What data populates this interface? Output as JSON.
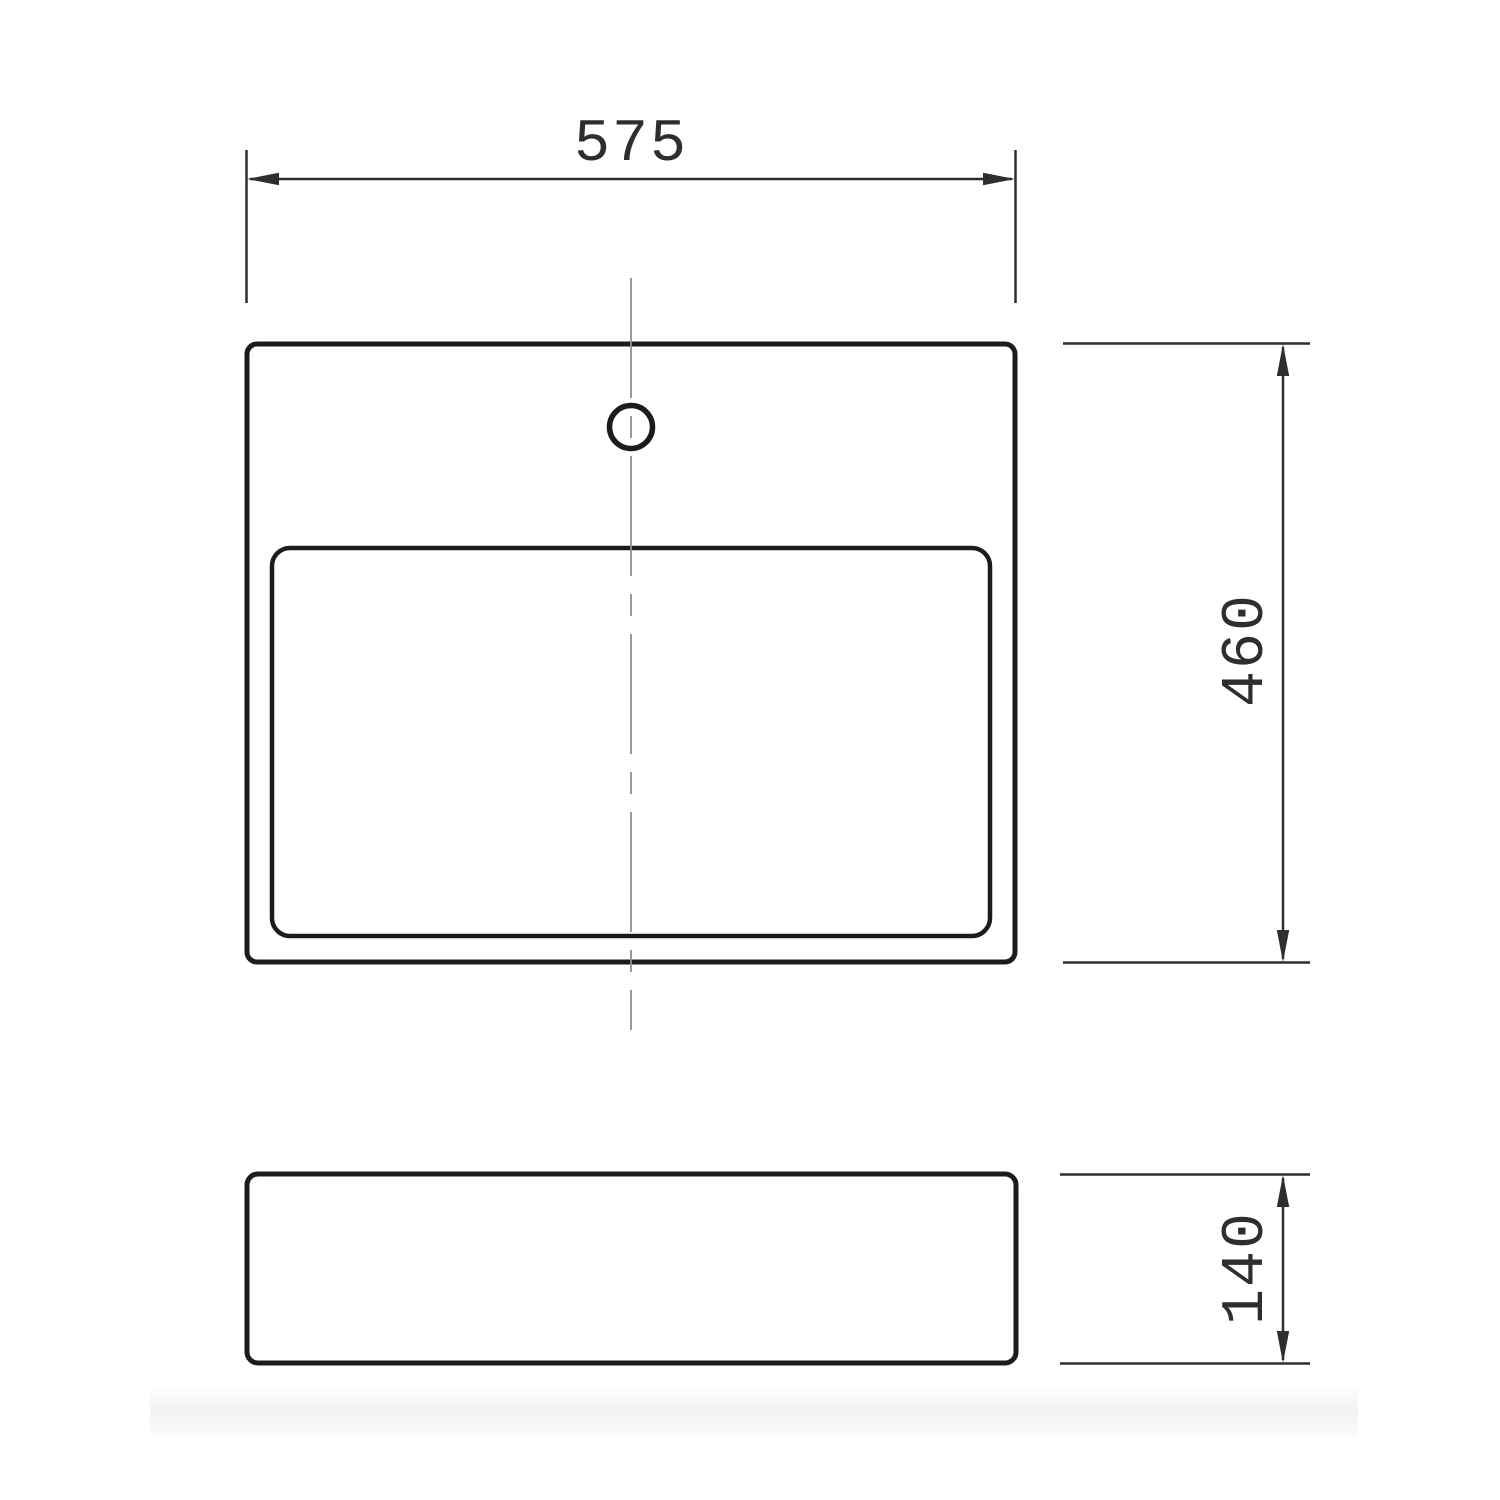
{
  "drawing": {
    "dimensions": {
      "width_label": "575",
      "depth_label": "460",
      "height_label": "140"
    },
    "colors": {
      "outline": "#1c1c1c",
      "dimension": "#2e2e2e",
      "centerline": "#8f8f8f",
      "background": "#ffffff",
      "shadow_band": "#f3f3f5"
    }
  }
}
